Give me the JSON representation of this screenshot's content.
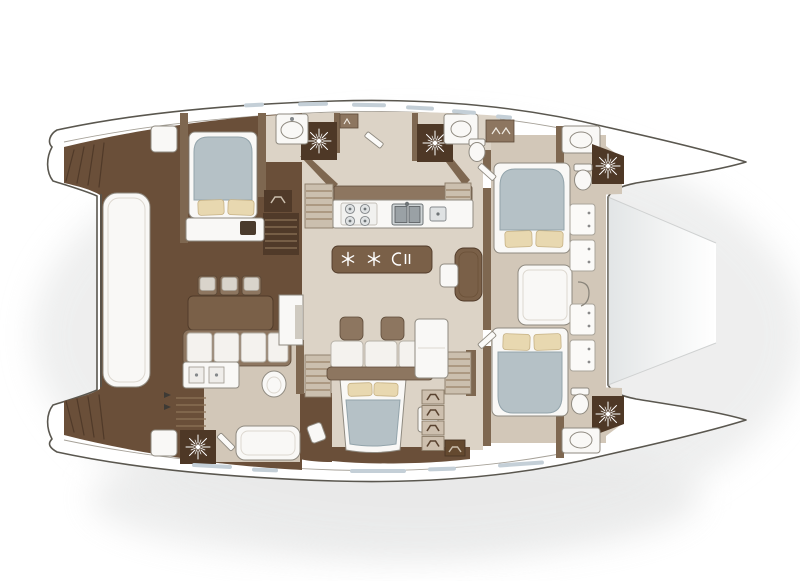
{
  "page": {
    "title": "Catamaran yacht top-down floor plan",
    "background": "#ffffff"
  },
  "palette": {
    "hull_outline": "#5a574f",
    "deck_line": "#a6a198",
    "deck_brown": "#6a4f39",
    "deck_brown_dark": "#503a29",
    "wall_brown": "#7e6750",
    "wood_mid": "#8d7660",
    "floor_beige": "#dcd3c6",
    "floor_beige_dark": "#d2c7b8",
    "tan_panel": "#cbbfae",
    "fixture_white": "#f9f8f6",
    "fixture_stroke": "#8f8a80",
    "duvet": "#b5c1c6",
    "duvet_stroke": "#93a4ab",
    "pillow": "#e8d8b0",
    "pillow_stroke": "#c6b184",
    "window_blue": "#c4cfd7",
    "shower_dark": "#4e3826",
    "shadow_gray": "#e0e1e1",
    "trampoline_gray": "#e2e5e6"
  },
  "plan": {
    "orientation": {
      "bow": "right",
      "stern": "left"
    },
    "inventory": {
      "double_beds": 4,
      "single_berths": 1,
      "shower_drains": 5,
      "toilets": 4,
      "wash_basins": 4,
      "staircases": 5,
      "deck_lockers": 4,
      "bar_stools": 3,
      "sofa_cushions": 7,
      "ottomans": 2,
      "galley": {
        "stove_burners": 4,
        "sink_bowls": 2,
        "cold_drawers": 2
      },
      "trampoline": 1,
      "stern_platform": 1,
      "transom_steps": 2
    },
    "icons": [
      "shower-drain-icon",
      "snowflake-icon",
      "stove-burner-icon",
      "sink-icon",
      "toilet-icon",
      "stairs-icon",
      "drawer-handle-icon",
      "anchor-hook-icon",
      "locker-hatch-icon",
      "companionway-arrow-icon"
    ]
  }
}
